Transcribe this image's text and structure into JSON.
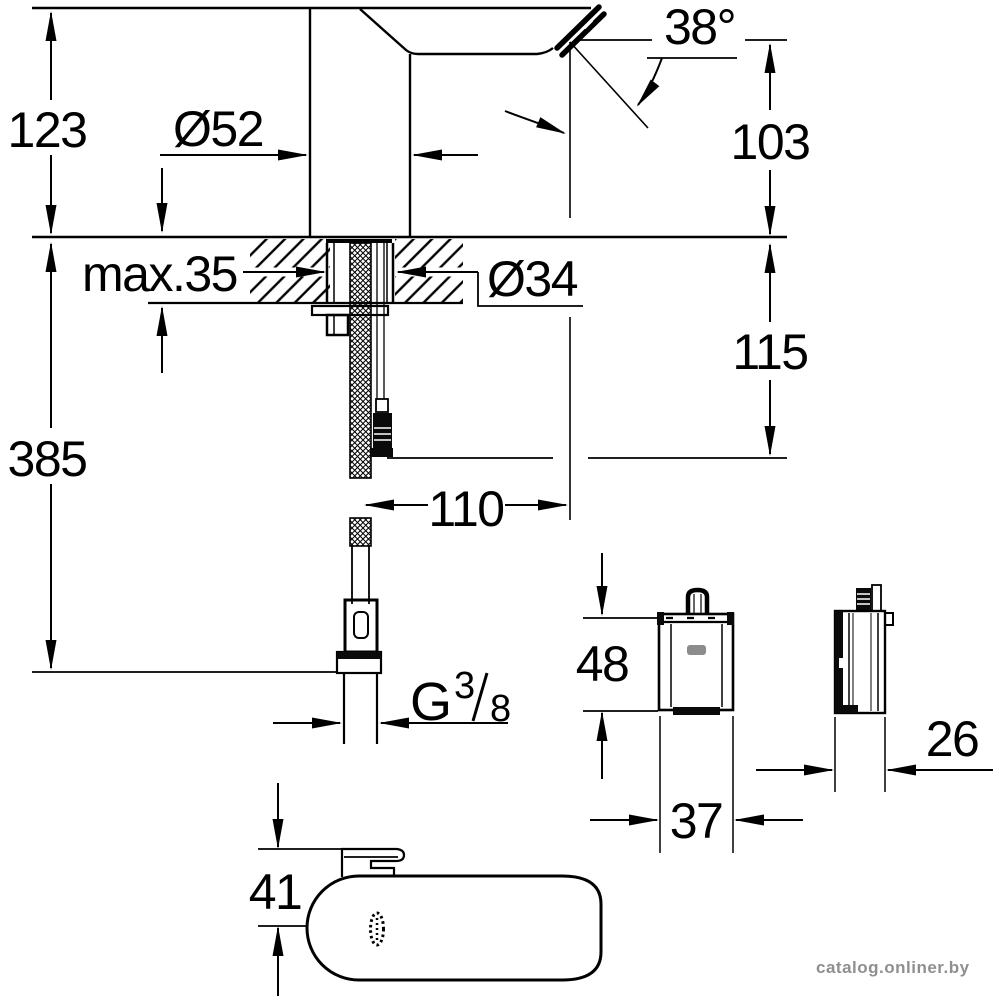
{
  "drawing_type": "faucet installation dimensional drawing",
  "dims": {
    "height_above_deck": "123",
    "body_diameter": "Ø52",
    "outlet_angle": "38°",
    "spout_outlet_height": "103",
    "max_deck_thickness": "max.35",
    "hole_diameter": "Ø34",
    "outlet_drop": "115",
    "total_height": "385",
    "spout_reach": "110",
    "control_box_height": "48",
    "control_box_width": "37",
    "control_box_depth": "26",
    "base_height": "41",
    "thread_letter": "G",
    "thread_numerator": "3",
    "thread_denominator": "8"
  },
  "watermark": {
    "text": "catalog.onliner.by",
    "color": "#8f8f8f"
  },
  "colors": {
    "ink": "#000000",
    "paper": "#ffffff",
    "logo_badge": "#8c8c8c"
  }
}
